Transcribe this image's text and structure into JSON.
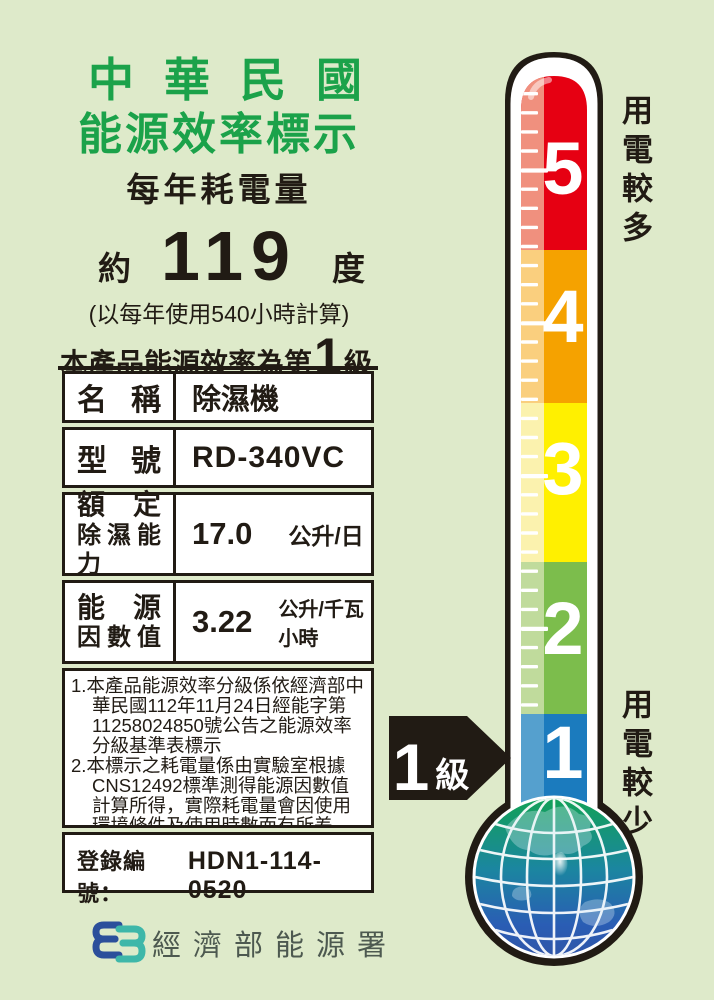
{
  "header": {
    "title_line1": "中華民國",
    "title_line2": "能源效率標示",
    "subtitle": "每年耗電量"
  },
  "consumption": {
    "prefix": "約",
    "value": "119",
    "unit": "度",
    "basis": "(以每年使用540小時計算)"
  },
  "grade": {
    "prefix": "本產品能源效率為第",
    "value": "1",
    "suffix": "級"
  },
  "table": {
    "rows": [
      {
        "label": "名 稱",
        "value": "除濕機"
      },
      {
        "label": "型 號",
        "value": "RD-340VC"
      },
      {
        "label1": "額 定",
        "label2": "除濕能力",
        "value": "17.0",
        "unit": "公升/日"
      },
      {
        "label1": "能 源",
        "label2": "因數值",
        "value": "3.22",
        "unit": "公升/千瓦小時"
      }
    ]
  },
  "notes": {
    "items": [
      "1.本產品能源效率分級係依經濟部中華民國112年11月24日經能字第11258024850號公告之能源效率分級基準表標示",
      "2.本標示之耗電量係由實驗室根據CNS12492標準測得能源因數值計算所得，實際耗電量會因使用環境條件及使用時數而有所差異。"
    ]
  },
  "registration": {
    "label": "登錄編號：",
    "value": "HDN1-114-0520"
  },
  "footer": {
    "agency": "經濟部能源署"
  },
  "thermometer": {
    "top_label": "用電較多",
    "bottom_label": "用電較少",
    "arrow": {
      "value": "1",
      "suffix": "級"
    },
    "levels": [
      {
        "value": "5",
        "color": "#E60012",
        "light": "#F0907E"
      },
      {
        "value": "4",
        "color": "#F5A200",
        "light": "#FACF7E"
      },
      {
        "value": "3",
        "color": "#FFF000",
        "light": "#FBF2AE"
      },
      {
        "value": "2",
        "color": "#7CBD4C",
        "light": "#C0DB9C"
      },
      {
        "value": "1",
        "color": "#1B7BBE",
        "light": "#55A0CE"
      }
    ],
    "accent_colors": {
      "background": "#DEEACA",
      "title_green": "#1BA24A",
      "ink": "#211B14",
      "globe_top": "#12A156",
      "globe_bottom": "#2A5DB4"
    }
  }
}
